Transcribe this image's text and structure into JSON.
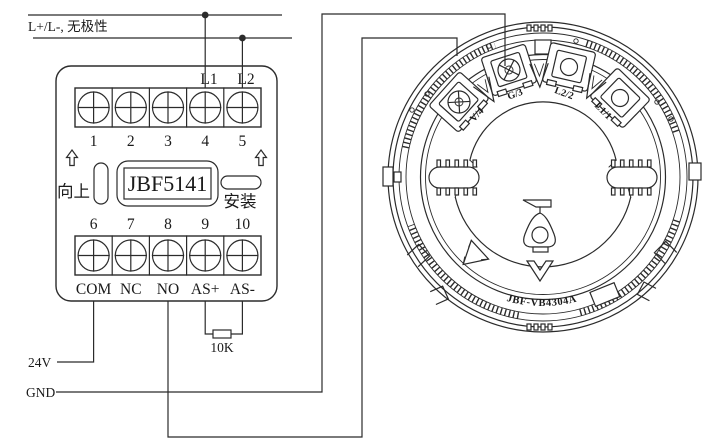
{
  "bus": {
    "label": "L+/L-, 无极性"
  },
  "module": {
    "model": "JBF5141",
    "orientation_label": "向上",
    "install_label": "安装",
    "terminal_l1": "L1",
    "terminal_l2": "L2",
    "top_numbers": [
      "1",
      "2",
      "3",
      "4",
      "5"
    ],
    "bottom_numbers": [
      "6",
      "7",
      "8",
      "9",
      "10"
    ],
    "bottom_labels": [
      "COM",
      "NC",
      "NO",
      "AS+",
      "AS-"
    ]
  },
  "wiring": {
    "supply_24v": "24V",
    "ground": "GND",
    "resistor": "10K"
  },
  "base": {
    "model": "JBF-VB4304A",
    "terminals": [
      "V/4",
      "G/3",
      "L2/2",
      "L1/1"
    ]
  },
  "colors": {
    "line": "#2b2b2b",
    "text": "#1a1a1a",
    "background": "#ffffff"
  }
}
